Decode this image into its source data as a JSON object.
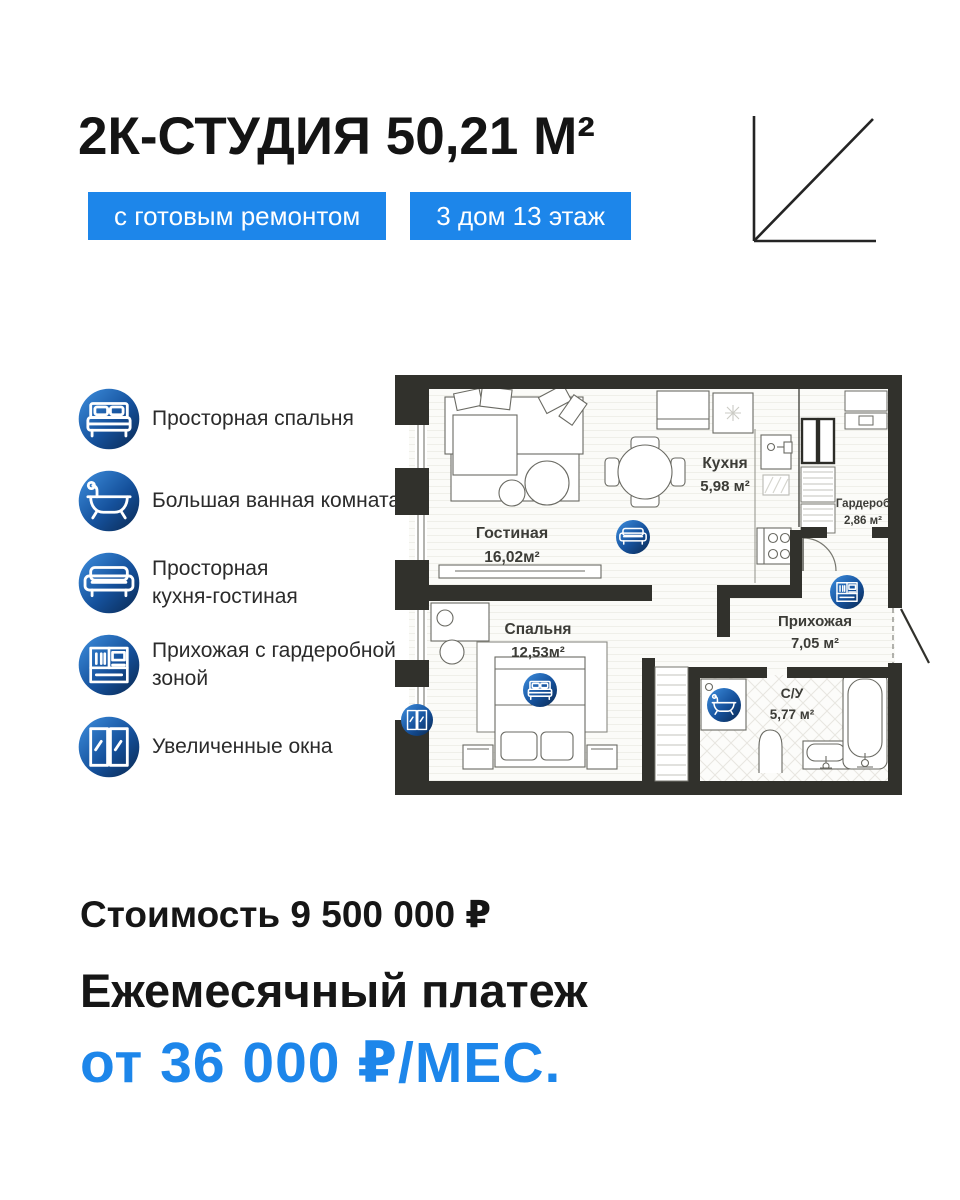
{
  "header": {
    "title": "2К-СТУДИЯ 50,21 М²",
    "badge_renovation": "с готовым ремонтом",
    "badge_location": "3 дом 13 этаж"
  },
  "features": [
    {
      "icon": "bed-icon",
      "label": "Просторная спальня"
    },
    {
      "icon": "bathtub-icon",
      "label": "Большая ванная комната"
    },
    {
      "icon": "sofa-icon",
      "label": "Просторная\nкухня-гостиная"
    },
    {
      "icon": "wardrobe-icon",
      "label": "Прихожая с гардеробной\nзоной"
    },
    {
      "icon": "window-icon",
      "label": "Увеличенные окна"
    }
  ],
  "floorplan": {
    "rooms": [
      {
        "name": "Гостиная",
        "area": "16,02м²"
      },
      {
        "name": "Кухня",
        "area": "5,98 м²"
      },
      {
        "name": "Гардероб",
        "area": "2,86 м²"
      },
      {
        "name": "Прихожая",
        "area": "7,05 м²"
      },
      {
        "name": "Спальня",
        "area": "12,53м²"
      },
      {
        "name": "С/У",
        "area": "5,77 м²"
      }
    ]
  },
  "pricing": {
    "price_line": "Стоимость 9 500 000 ₽",
    "payment_label": "Ежемесячный платеж",
    "payment_value": "от 36 000 ₽/МЕС."
  },
  "colors": {
    "accent_blue": "#1d86ea",
    "wall_dark": "#31312c",
    "icon_gradient_top": "#3e8fdf",
    "icon_gradient_bottom": "#0a2850"
  }
}
